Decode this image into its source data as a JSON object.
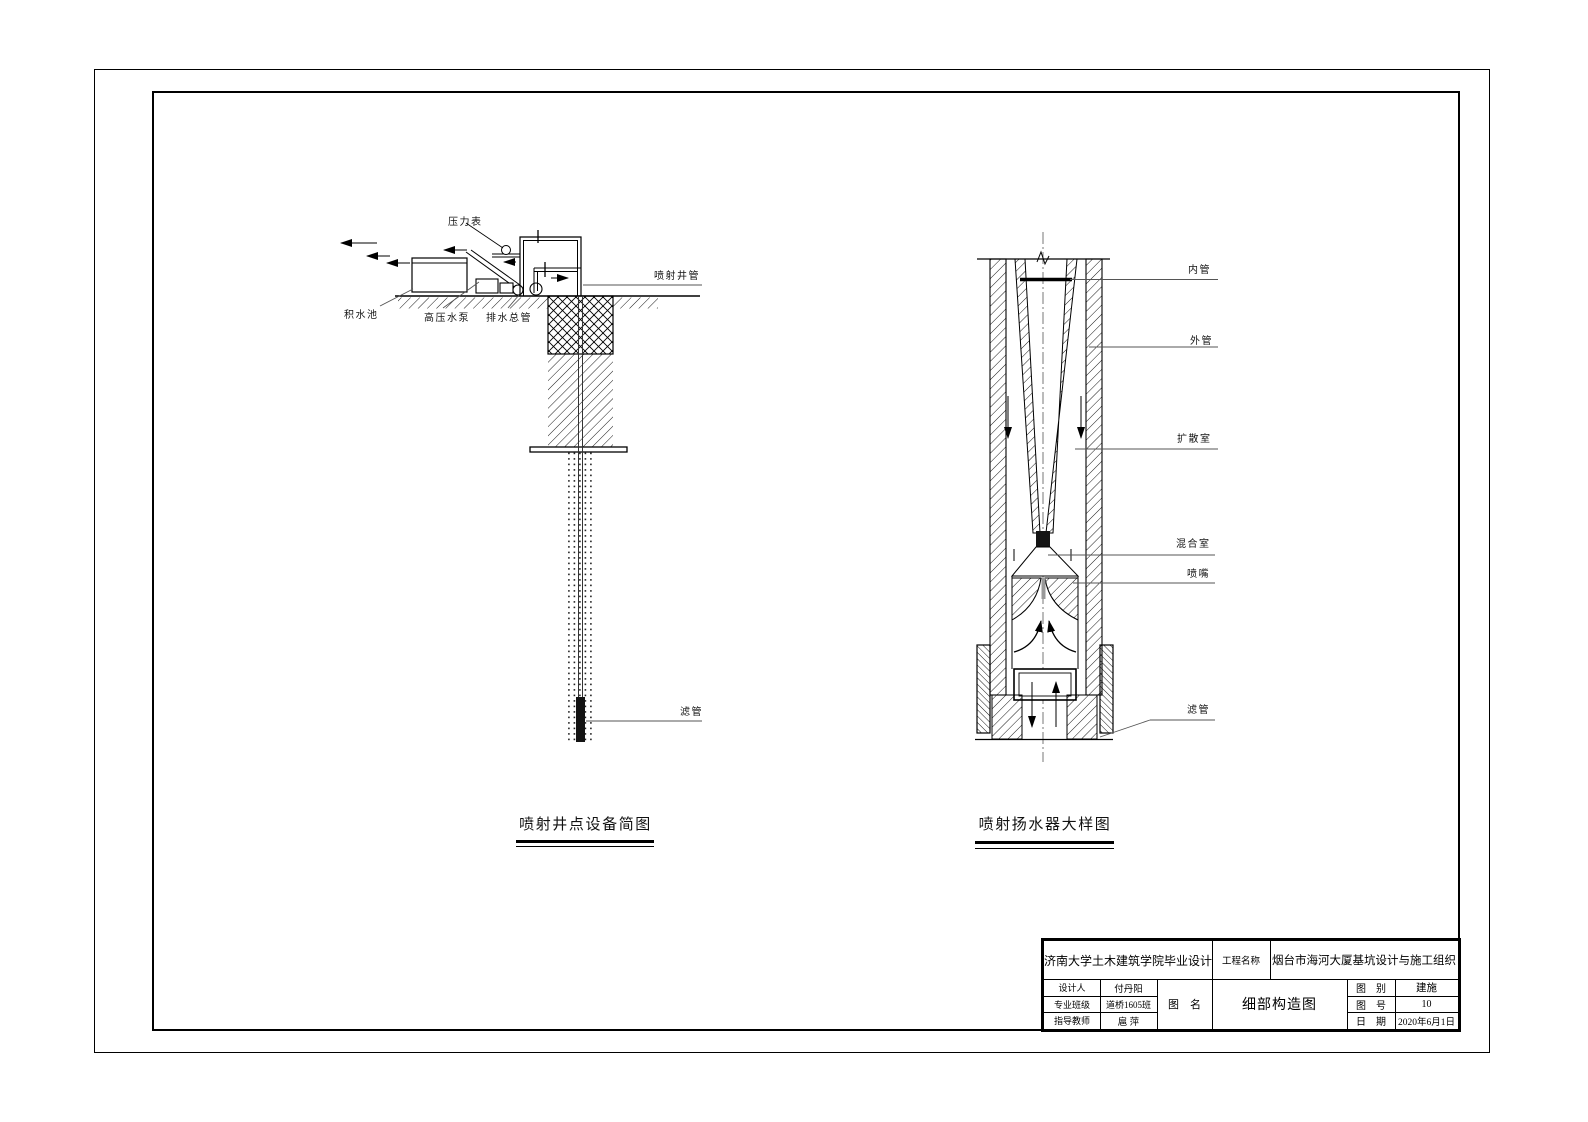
{
  "sheet": {
    "captions": {
      "left": "喷射井点设备简图",
      "right": "喷射扬水器大样图"
    },
    "left_diagram_labels": {
      "pressure_gauge": "压力表",
      "sump": "积水池",
      "pump": "高压水泵",
      "drain_main": "排水总管",
      "jet_well_pipe": "喷射井管",
      "filter_pipe": "滤管"
    },
    "right_diagram_labels": {
      "inner_pipe": "内管",
      "outer_pipe": "外管",
      "diffusion_chamber": "扩散室",
      "mixing_chamber": "混合室",
      "nozzle": "喷嘴",
      "filter_pipe": "滤管"
    },
    "title_block": {
      "school": "济南大学土木建筑学院毕业设计",
      "project_label": "工程名称",
      "project_name": "烟台市海河大厦基坑设计与施工组织",
      "designer_label": "设计人",
      "designer": "付丹阳",
      "class_label": "专业班级",
      "class_name": "道桥1605班",
      "advisor_label": "指导教师",
      "advisor": "扈 萍",
      "drawing_name_label": "图　名",
      "drawing_name": "细部构造图",
      "category_label": "图　别",
      "category": "建施",
      "number_label": "图　号",
      "number": "10",
      "date_label": "日　期",
      "date": "2020年6月1日"
    }
  }
}
